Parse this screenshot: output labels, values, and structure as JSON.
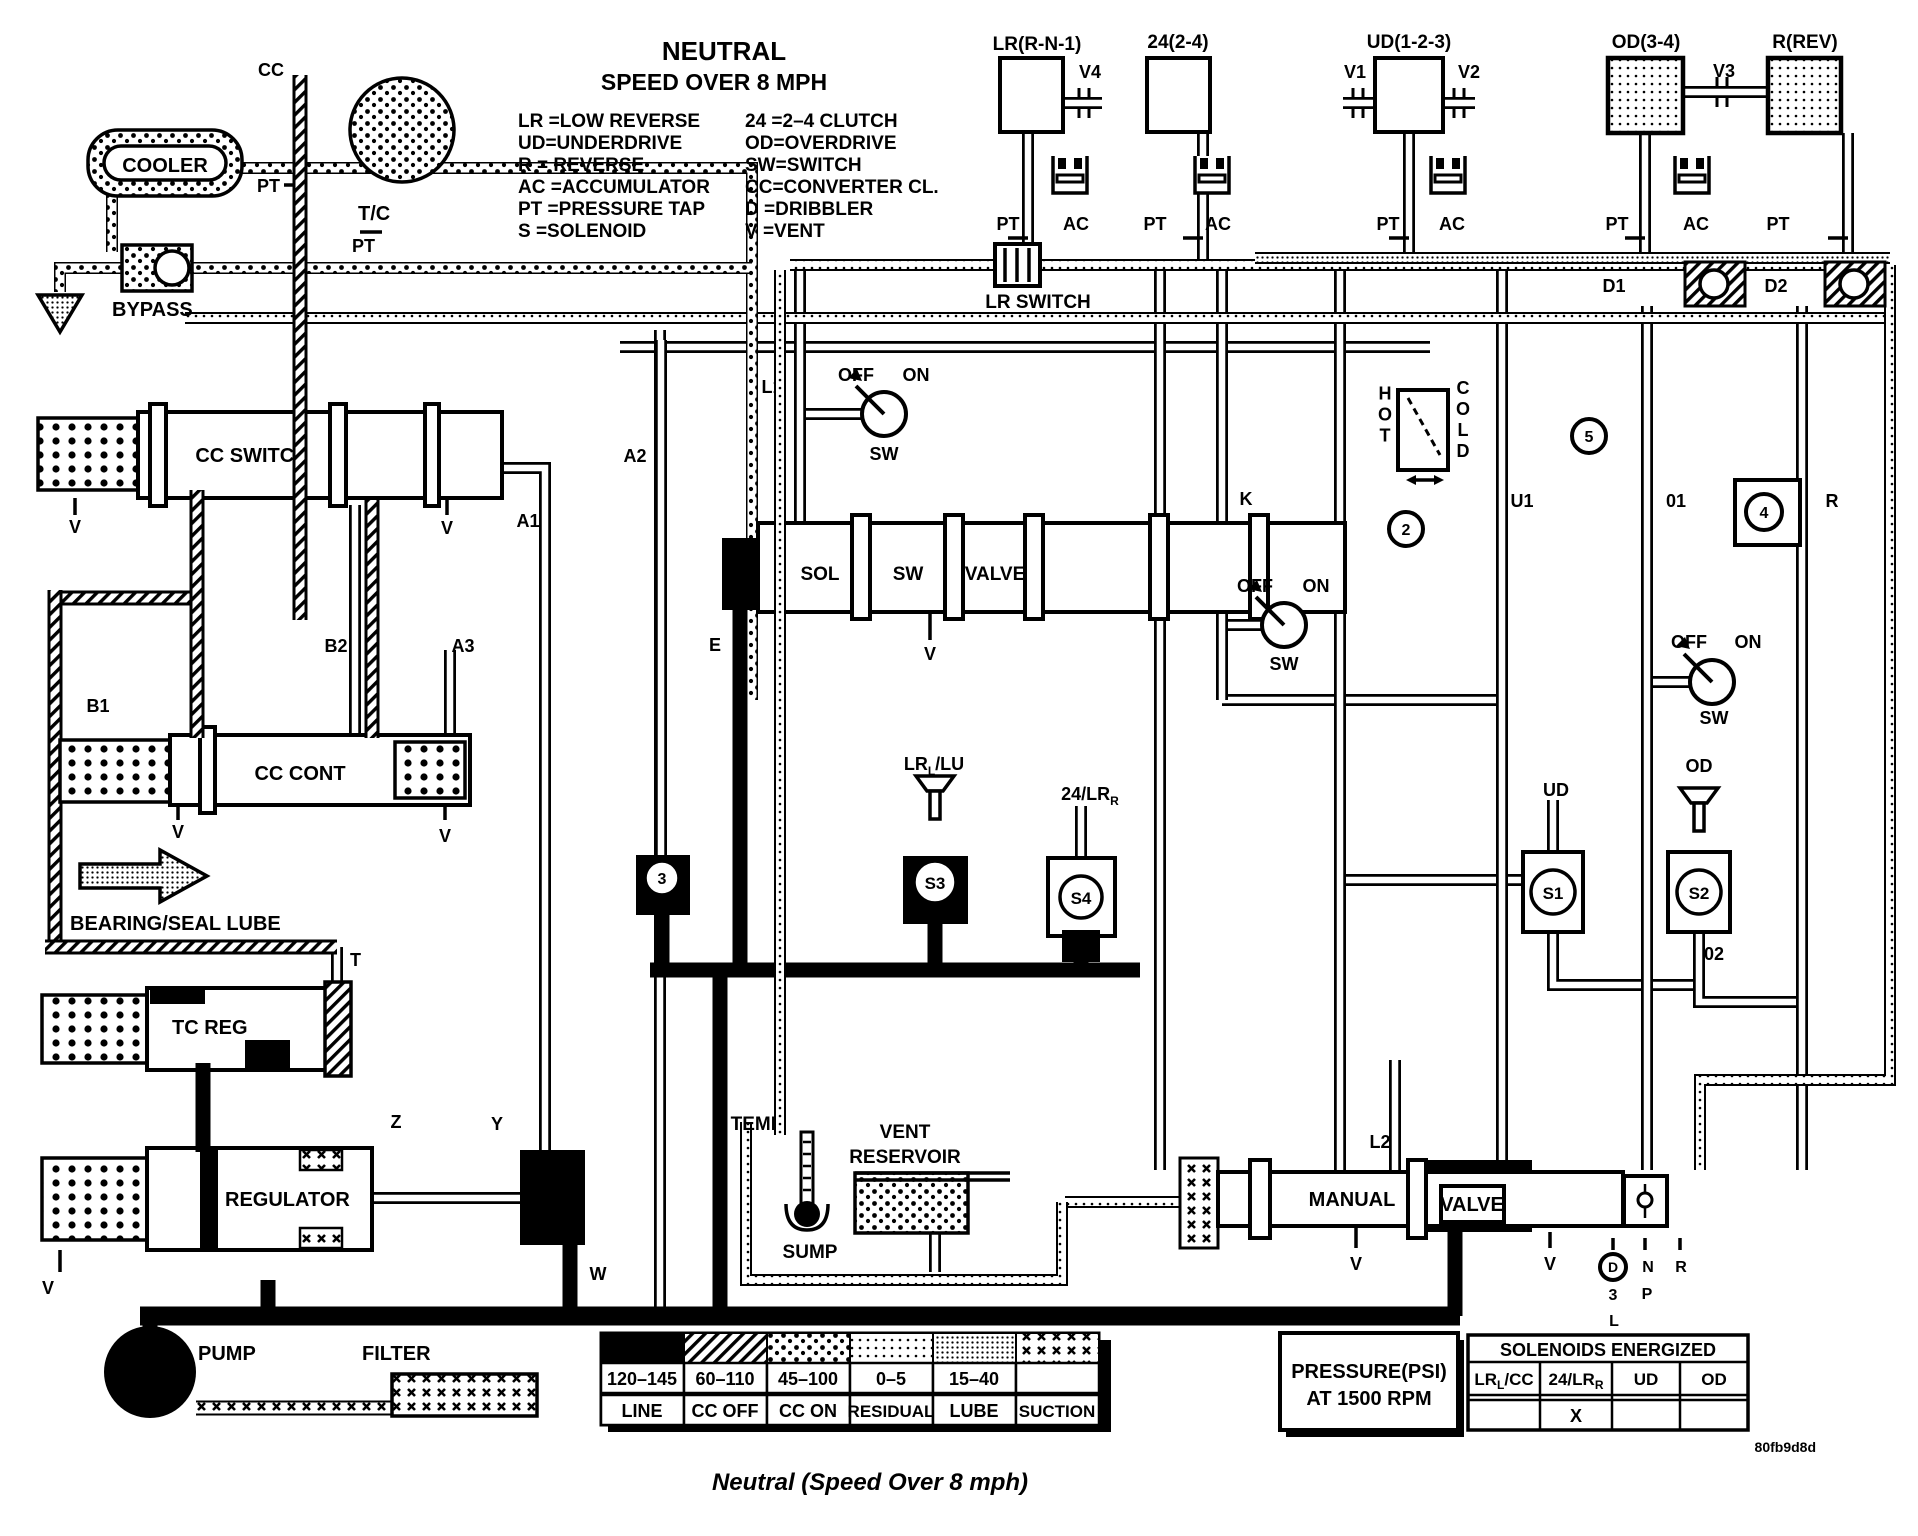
{
  "title": {
    "name": "NEUTRAL",
    "condition": "SPEED OVER 8 MPH"
  },
  "abbreviations": {
    "left": [
      "LR =LOW REVERSE",
      "UD=UNDERDRIVE",
      "R  = REVERSE",
      "AC =ACCUMULATOR",
      "PT =PRESSURE TAP",
      "S  =SOLENOID"
    ],
    "right": [
      "24 =2–4 CLUTCH",
      "OD=OVERDRIVE",
      "SW=SWITCH",
      "CC=CONVERTER CL.",
      "D  =DRIBBLER",
      "V  =VENT"
    ]
  },
  "clutches": {
    "lr": {
      "header": "LR(R-N-1)",
      "vent": "V4"
    },
    "c24": {
      "header": "24(2-4)"
    },
    "ud": {
      "header": "UD(1-2-3)",
      "vent_left": "V1",
      "vent_right": "V2"
    },
    "od": {
      "header": "OD(3-4)",
      "vent": "V3"
    },
    "rev": {
      "header": "R(REV)"
    }
  },
  "ports": {
    "pt": "PT",
    "ac": "AC",
    "v": "V",
    "d1": "D1",
    "d2": "D2",
    "a1": "A1",
    "a2": "A2",
    "a3": "A3",
    "b1": "B1",
    "b2": "B2",
    "e": "E",
    "k": "K",
    "l1": "L1",
    "l2": "L2",
    "t": "T",
    "u1": "U1",
    "o1": "01",
    "o2": "02",
    "w": "W",
    "y": "Y",
    "z": "Z",
    "r": "R"
  },
  "components": {
    "cc": "CC",
    "tc": "T/C",
    "cooler": "COOLER",
    "bypass": "BYPASS",
    "cc_switch": "CC SWITCH",
    "cc_cont": "CC CONT",
    "lr_switch": "LR SWITCH",
    "bearing_lube": "BEARING/SEAL LUBE",
    "tc_reg": "TC REG",
    "regulator": "REGULATOR",
    "pump": "PUMP",
    "filter": "FILTER",
    "sol": "SOL",
    "sw": "SW",
    "valve": "VALVE",
    "manual": "MANUAL",
    "temp": "TEMP",
    "sump": "SUMP",
    "vent": "VENT",
    "reservoir": "RESERVOIR",
    "hot": "HOT",
    "cold": "COLD",
    "ud": "UD",
    "od": "OD"
  },
  "switch": {
    "off": "OFF",
    "on": "ON",
    "sw": "SW"
  },
  "solenoid_ids": {
    "s1": "S1",
    "s2": "S2",
    "s3": "S3",
    "s4": "S4"
  },
  "solenoid_feeds": {
    "lrl_lu": {
      "main": "LR",
      "sub": "L",
      "rest": "/LU"
    },
    "lrr_24": {
      "main": "24/LR",
      "sub": "R",
      "rest": ""
    }
  },
  "circled": {
    "n2": "2",
    "n3": "3",
    "n4": "4",
    "n5": "5",
    "d": "D"
  },
  "shifter": {
    "three": "3",
    "l": "L",
    "n": "N",
    "p": "P",
    "r": "R"
  },
  "pressure_legend": {
    "title_lines": [
      "PRESSURE(PSI)",
      "AT 1500 RPM"
    ],
    "entries": [
      {
        "range": "120–145",
        "label": "LINE",
        "pattern": "line"
      },
      {
        "range": "60–110",
        "label": "CC OFF",
        "pattern": "cc-off"
      },
      {
        "range": "45–100",
        "label": "CC ON",
        "pattern": "cc-on"
      },
      {
        "range": "0–5",
        "label": "RESIDUAL",
        "pattern": "residual"
      },
      {
        "range": "15–40",
        "label": "LUBE",
        "pattern": "lube"
      },
      {
        "range": "",
        "label": "SUCTION",
        "pattern": "suction"
      }
    ]
  },
  "solenoids_energized": {
    "title": "SOLENOIDS ENERGIZED",
    "columns": [
      {
        "main": "LR",
        "sub": "L",
        "rest": "/CC"
      },
      {
        "main": "24/LR",
        "sub": "R",
        "rest": ""
      },
      {
        "main": "UD",
        "sub": "",
        "rest": ""
      },
      {
        "main": "OD",
        "sub": "",
        "rest": ""
      }
    ],
    "values": [
      "",
      "X",
      "",
      ""
    ]
  },
  "figure_code": "80fb9d8d",
  "caption": "Neutral (Speed Over 8 mph)",
  "colors": {
    "ink": "#000000",
    "paper": "#ffffff"
  }
}
